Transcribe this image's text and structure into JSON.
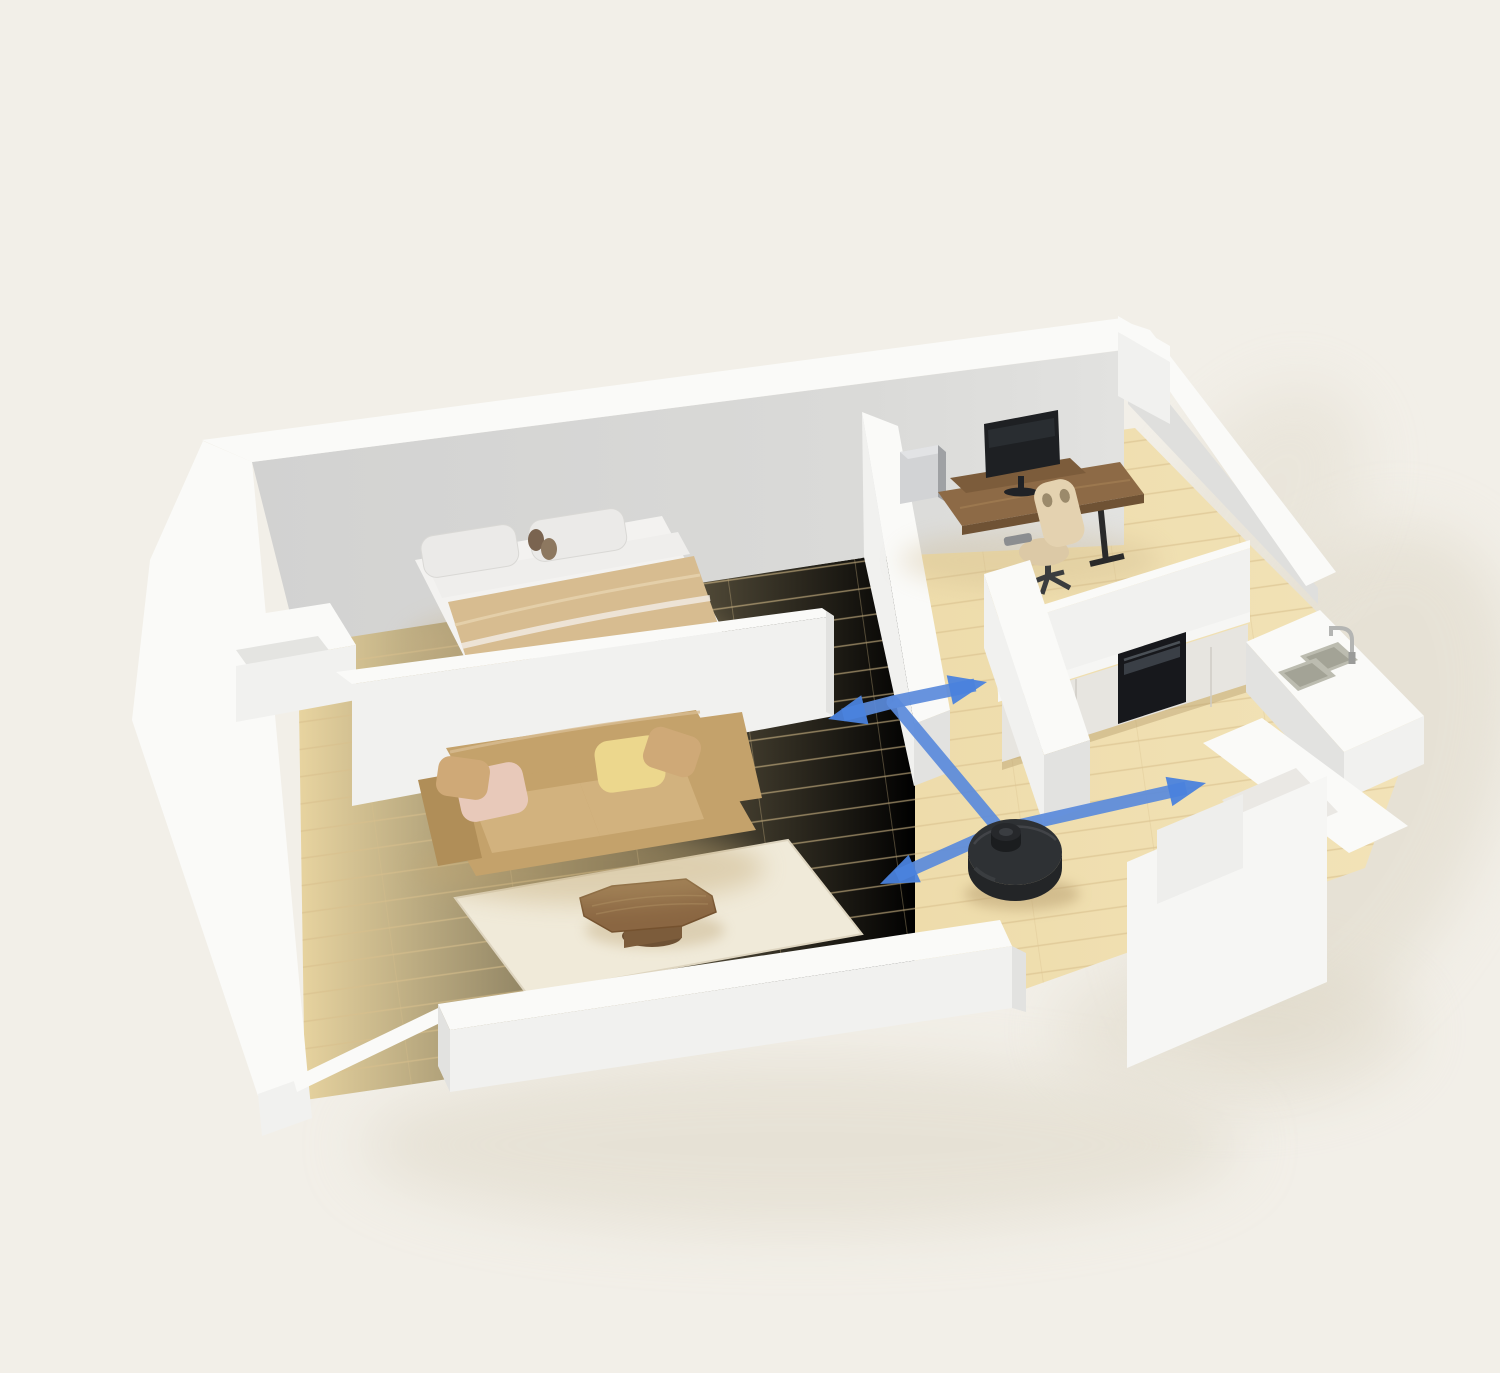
{
  "scene": {
    "subject": "isometric-apartment-cutaway-with-robot-vacuum-route",
    "rooms": [
      "bedroom",
      "living-room",
      "home-office",
      "kitchen-dining",
      "hallway",
      "bathroom"
    ],
    "furniture": [
      "double-bed",
      "bed-pillows",
      "tan-duvet",
      "entry-nook",
      "leather-sofa",
      "throw-pillows",
      "area-rug",
      "round-coffee-table",
      "standing-desk",
      "monitor-riser",
      "curved-monitor",
      "desktop-pc-tower",
      "gaming-chair",
      "kitchen-cabinet-row",
      "built-in-oven",
      "countertop",
      "sink-counter",
      "double-basin-sink",
      "faucet"
    ],
    "robot": {
      "name": "robot-vacuum",
      "style": "round body with lidar turret"
    }
  },
  "palette": {
    "bg": "#f2efe8",
    "shadow": "#dcd5c4",
    "floor": "#ecd9a8",
    "floor-light": "#f2e3b8",
    "floor-line": "#d8bf8c",
    "wall-top": "#fafaf8",
    "wall-lit": "#f1f1ef",
    "wall-side": "#e2e2e0",
    "wall-inner-left": "#d2d2d1",
    "wall-inner-right": "#e2e2e0",
    "wall-inner2": "#dfdfdd",
    "counter": "#f6f6f4",
    "cabinet": "#e7e5e0",
    "cabinet-seam": "#cfccc5",
    "oven": "#17181c",
    "oven-glass": "#3a3f46",
    "sink": "#bcbcb0",
    "sink-inner": "#a3a396",
    "faucet": "#b4b5b3",
    "sheet": "#f3f2f0",
    "bed-front": "#e2e1df",
    "sheet-band": "#efeeec",
    "blanket": "#d7bc90",
    "pillow": "#ebeae8",
    "pillow-edge": "#d9d8d5",
    "sofa": "#c4a26b",
    "sofa-dark": "#b08e58",
    "sofa-light": "#d2b27e",
    "pillow-pink": "#e8c9ba",
    "pillow-yellow": "#ecd78d",
    "pillow-tan": "#cfa977",
    "rug": "#f0ead9",
    "rug-edge": "#ded5c0",
    "wood-mid": "#7c5c3b",
    "wood-dark": "#6e5134",
    "desk": "#8d6a46",
    "desk-edge": "#6f5234",
    "monitor": "#1e2023",
    "pc": "#d2d3d5",
    "pc-side": "#9fa1a4",
    "chair": "#e4d2b0",
    "chair-edge": "#cbb astray",
    "chair-seat": "#dcc9a6",
    "robot-body": "#232527",
    "robot-top": "#2e3134",
    "robot-turret": "#1b1d1f",
    "path-blue": "#5b8bdc",
    "arrow-blue": "#4a82dd"
  },
  "navigation_path": {
    "stroke_width": 13,
    "opacity": 0.92,
    "junctions": [
      [
        893,
        702
      ],
      [
        1000,
        830
      ]
    ],
    "segments": [
      [
        [
          893,
          702
        ],
        [
          843,
          715
        ]
      ],
      [
        [
          893,
          702
        ],
        [
          975,
          685
        ]
      ],
      [
        [
          893,
          702
        ],
        [
          1000,
          830
        ]
      ],
      [
        [
          1000,
          830
        ],
        [
          1186,
          788
        ]
      ],
      [
        [
          1000,
          830
        ],
        [
          897,
          876
        ]
      ]
    ],
    "arrows": [
      {
        "tip": [
          828,
          719
        ],
        "angle": 166
      },
      {
        "tip": [
          987,
          682
        ],
        "angle": -12
      },
      {
        "tip": [
          1206,
          783
        ],
        "angle": -13
      },
      {
        "tip": [
          880,
          884
        ],
        "angle": 156
      }
    ]
  }
}
